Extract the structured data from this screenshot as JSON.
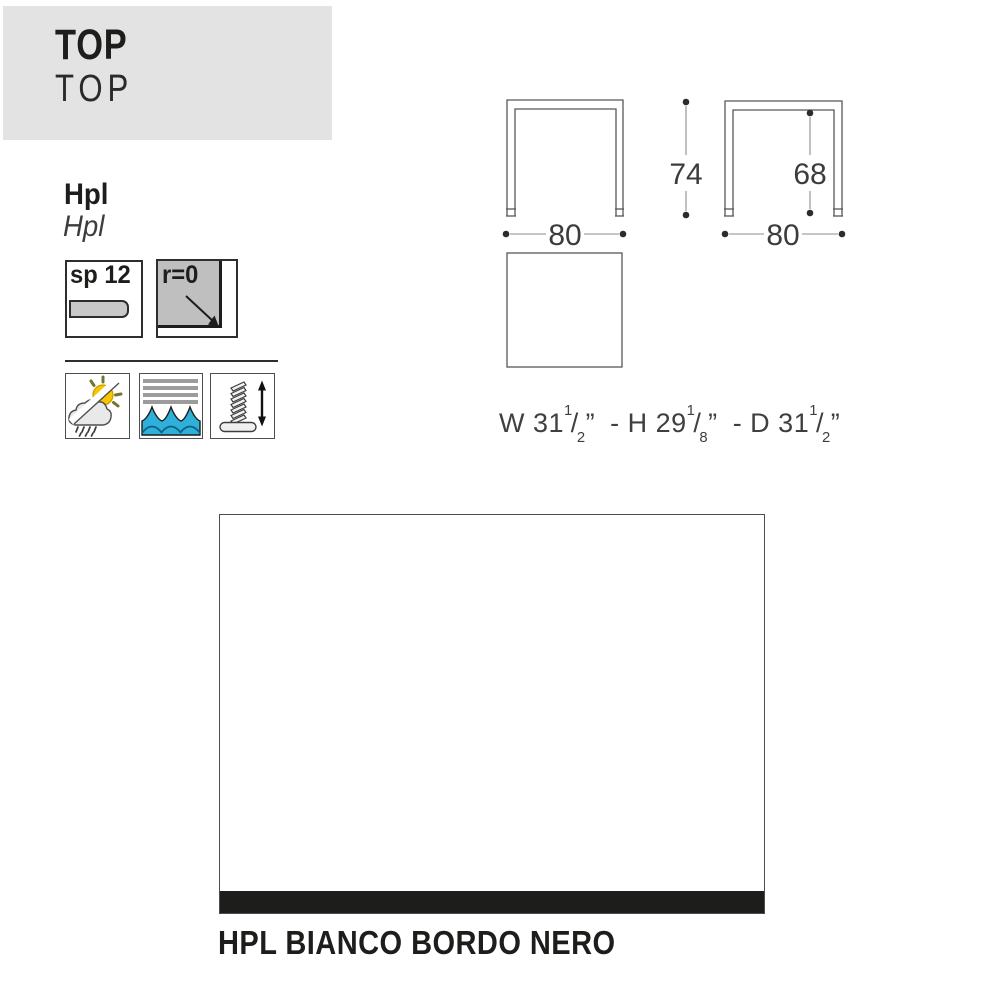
{
  "header": {
    "title": "TOP",
    "subtitle": "TOP"
  },
  "material": {
    "name": "Hpl",
    "name_alt": "Hpl"
  },
  "specs": {
    "thickness_label": "sp 12",
    "radius_label": "r=0"
  },
  "icons": {
    "weather": "outdoor-weather-resistant",
    "waves": "water-washable",
    "glide": "height-adjustable-glide"
  },
  "drawing": {
    "front_width": "80",
    "front_height": "74",
    "side_width": "80",
    "side_underframe_height": "68"
  },
  "spec_line": {
    "slash": "/",
    "unit": "”",
    "w_prefix": "W 31",
    "w_num": "1",
    "w_den": "2",
    "h_prefix": "- H 29",
    "h_num": "1",
    "h_den": "8",
    "d_prefix": "- D 31",
    "d_num": "1",
    "d_den": "2"
  },
  "finish": {
    "caption": "HPL BIANCO BORDO NERO"
  },
  "colors": {
    "banner_gray": "#e3e3e3",
    "line_gray": "#56585a",
    "edge_black": "#1d1d1b",
    "wave_blue": "#2fb0da",
    "sun_yellow": "#f7c600"
  }
}
